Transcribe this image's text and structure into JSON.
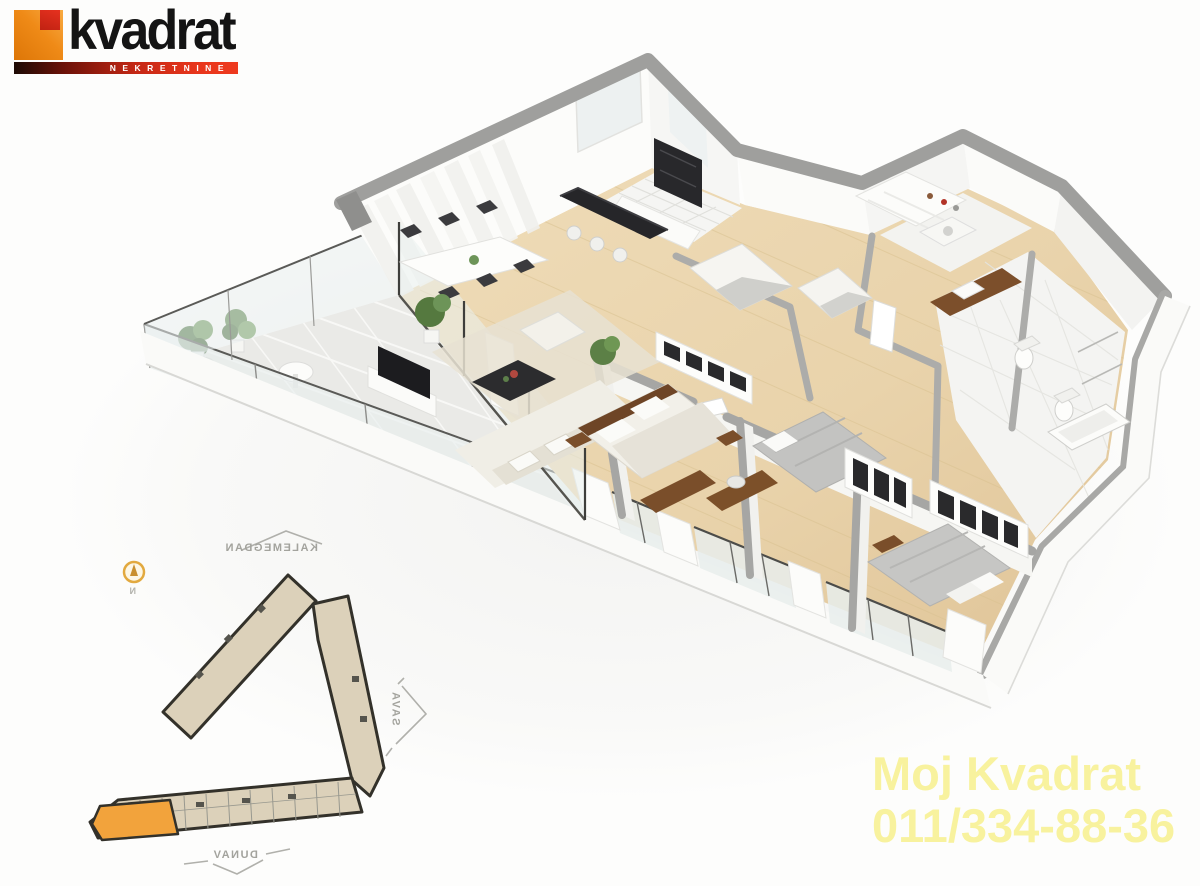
{
  "brand": {
    "name": "kvadrat",
    "tagline": "NEKRETNINE"
  },
  "contact": {
    "label": "Moj Kvadrat",
    "phone": "011/334-88-36"
  },
  "map": {
    "north": "N",
    "landmark_top": "KALEMEGDAN",
    "landmark_right": "SAVA",
    "landmark_bottom": "DUNAV"
  },
  "palette": {
    "logo_orange": "#EF8A17",
    "logo_red": "#DB2B1A",
    "contact_yellow": "#F8F29E",
    "map_building_fill": "#DCD1BA",
    "map_unit_highlight": "#F2A33C",
    "plan_wall_gray": "#9F9F9D",
    "plan_wood_floor": "#E9D3AB",
    "plan_tile": "#F4F4F2",
    "plan_dark_furniture": "#28282B"
  }
}
